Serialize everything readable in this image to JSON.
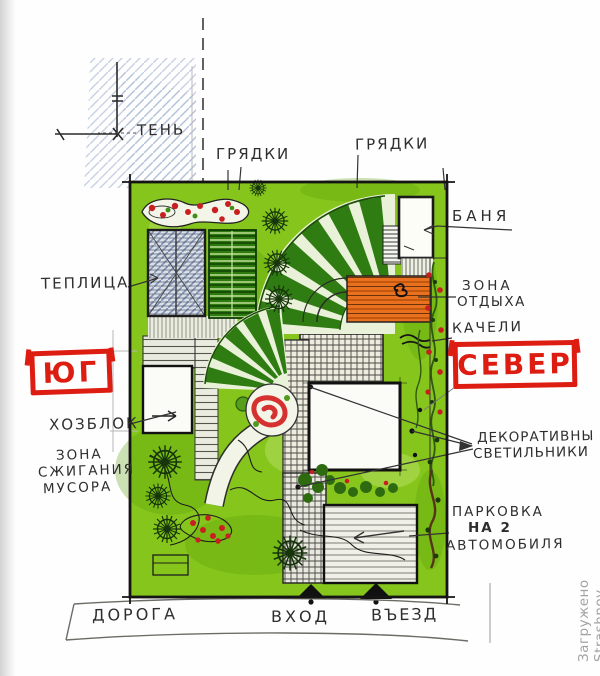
{
  "title": "Hand-drawn garden site plan sketch",
  "compass": {
    "south": "ЮГ",
    "north": "СЕВЕР"
  },
  "labels": {
    "shadow": "ТЕНЬ",
    "beds1": "ГРЯДКИ",
    "beds2": "ГРЯДКИ",
    "bathhouse": "БАНЯ",
    "rest1": "ЗОНА",
    "rest2": "ОТДЫХА",
    "swing": "КАЧЕЛИ",
    "greenhouse": "ТЕПЛИЦА",
    "shed": "ХОЗБЛОК",
    "burn1": "ЗОНА",
    "burn2": "СЖИГАНИЯ",
    "burn3": "МУСОРА",
    "lights1": "ДЕКОРАТИВНЫ",
    "lights2": "СВЕТИЛЬНИКИ",
    "parking1": "ПАРКОВКА",
    "parking2": "НА 2",
    "parking3": "АВТОМОБИЛЯ",
    "road": "ДОРОГА",
    "entrance": "ВХОД",
    "drivein": "ВЪЕЗД"
  },
  "watermark": {
    "text": "Загружено Strashnov для 7dach.ru"
  },
  "colors": {
    "accent_red": "#dd1d12",
    "plan_green": "#86c61c",
    "bed_dark_green": "#2d7a0e",
    "deck_orange": "#e8701f",
    "hatch_blue": "#8194b8",
    "ink": "#1d1d1d"
  }
}
